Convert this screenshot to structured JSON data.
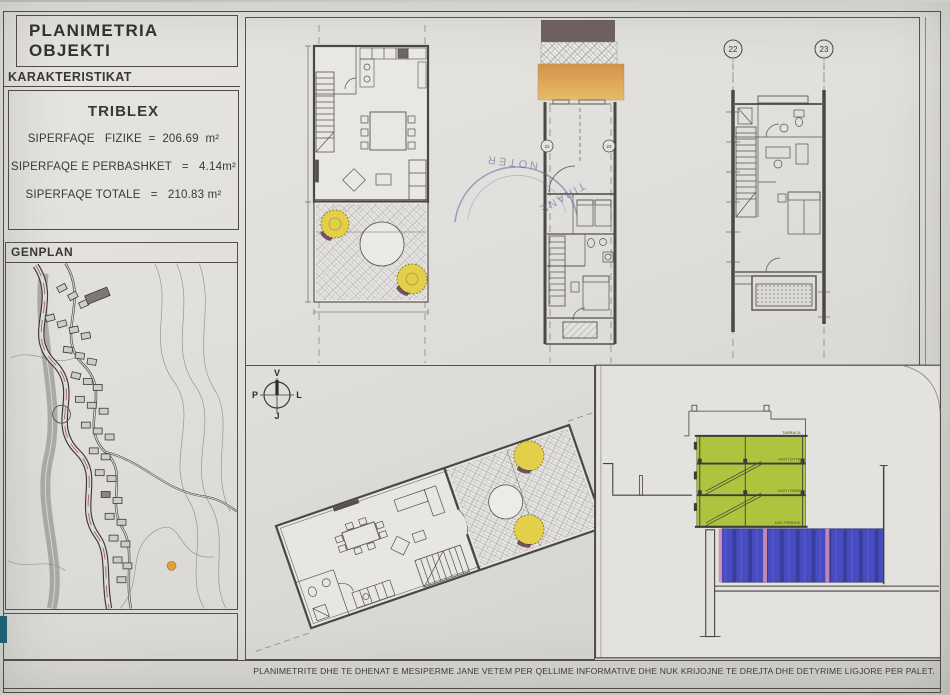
{
  "title_block": {
    "title": "PLANIMETRIA OBJEKTI",
    "section_label": "KARAKTERISTIKAT",
    "unit_name": "TRIBLEX",
    "area_lines": [
      "SIPERFAQE   FIZIKE  =  206.69  m²",
      "SIPERFAQE E PERBASHKET   =   4.14m²",
      "SIPERFAQE TOTALE   =   210.83 m²"
    ]
  },
  "genplan": {
    "label": "GENPLAN"
  },
  "compass": {
    "north": "V",
    "east": "L",
    "south": "J",
    "west": "P"
  },
  "grid_bubbles": {
    "left": "22",
    "right": "23",
    "mid_left": "22",
    "mid_right": "23"
  },
  "stamp": {
    "line1": "NOTER",
    "line2": "TIRANE"
  },
  "section_labels": {
    "roof": "TARRACA",
    "floor2": "KATI I DYTE",
    "floor1": "KATI I PARE",
    "ground": "KATI PERDHE"
  },
  "footer": {
    "disclaimer": "PLANIMETRITE DHE TE DHENAT E MESIPERME JANE VETEM PER QELLIME INFORMATIVE DHE NUK KRIJOJNE TE DREJTA DHE DETYRIME LIGJORE PER PALET."
  },
  "colors": {
    "section_green": "#adc43e",
    "section_blue": "#474cc0",
    "band_orange": "#dfa455",
    "band_brown": "#6e5f60",
    "tree_yellow": "#e3cf49",
    "stamp_blue": "#5a6a9a",
    "swatch_teal": "#1e5f72",
    "road_red": "#a23737"
  }
}
